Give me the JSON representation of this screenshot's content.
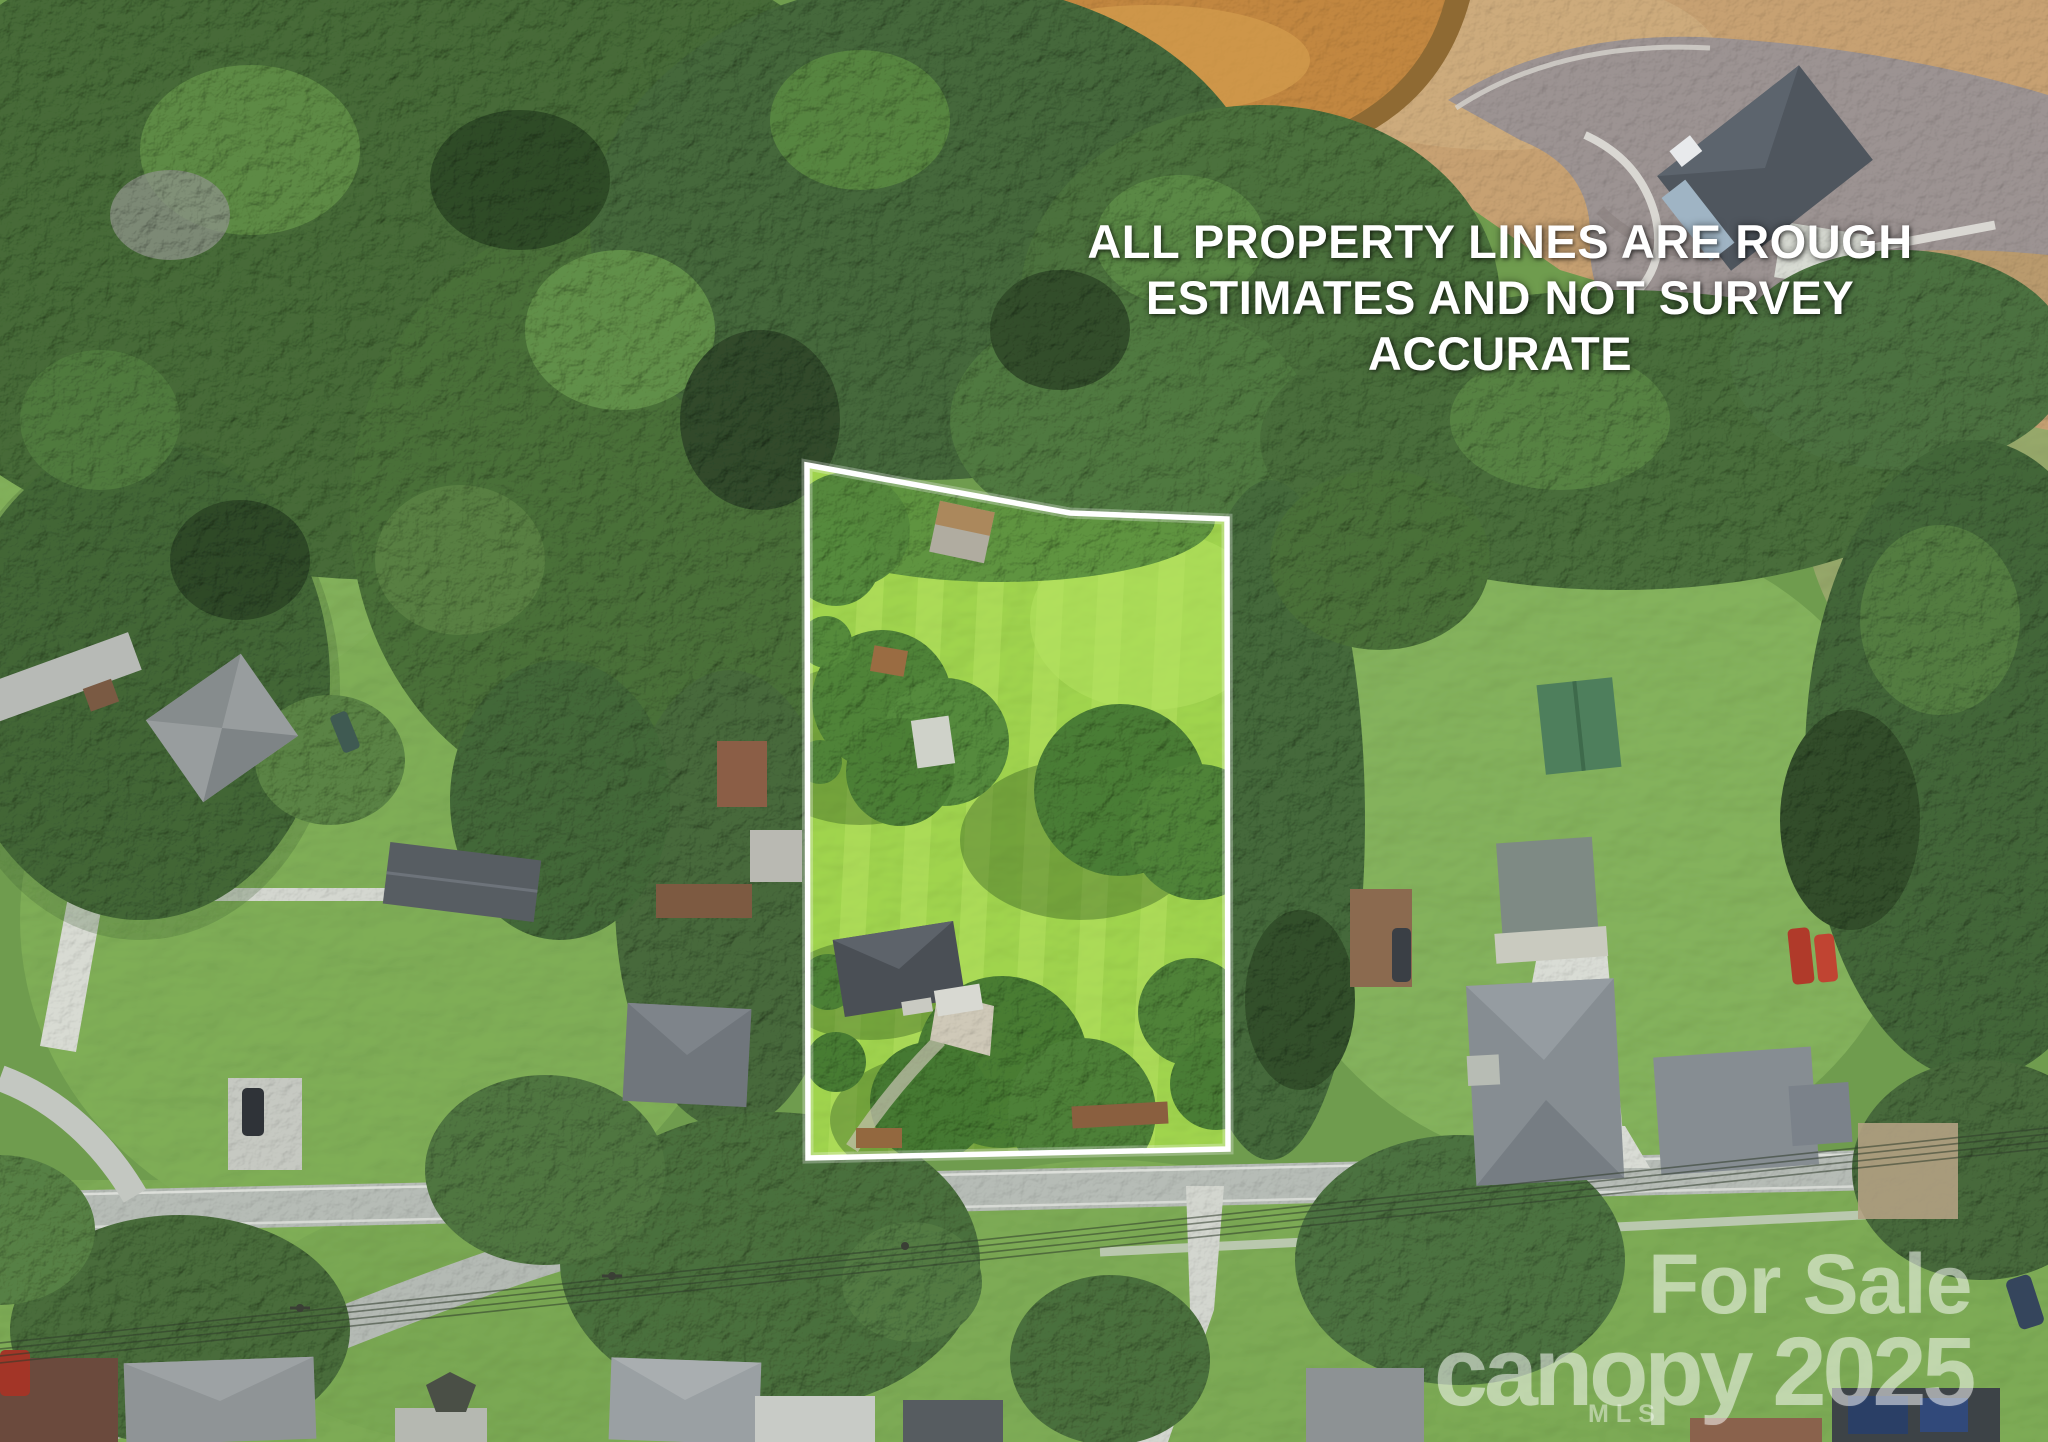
{
  "image_type": "aerial-drone-real-estate-photo",
  "disclaimer": {
    "lines": [
      "ALL PROPERTY LINES ARE ROUGH",
      "ESTIMATES AND NOT SURVEY",
      "ACCURATE"
    ]
  },
  "watermark": {
    "for_sale": "For Sale",
    "brand_year": "canopy 2025",
    "mls": "MLS"
  },
  "palette": {
    "boundary": "#FFFFFF",
    "disclaimer_text": "#FFFFFF",
    "watermark_text": "#FFFFFF",
    "lot_grass": "#A0D44E",
    "lawn": "#7EAC56",
    "forest": "#47693B",
    "asphalt": "#B6BCB6",
    "culdesac_asphalt": "#9C9392",
    "concrete": "#D9DCD5",
    "pond_water": "#C28740",
    "dirt": "#C7A172",
    "roof_dark": "#53585E"
  }
}
